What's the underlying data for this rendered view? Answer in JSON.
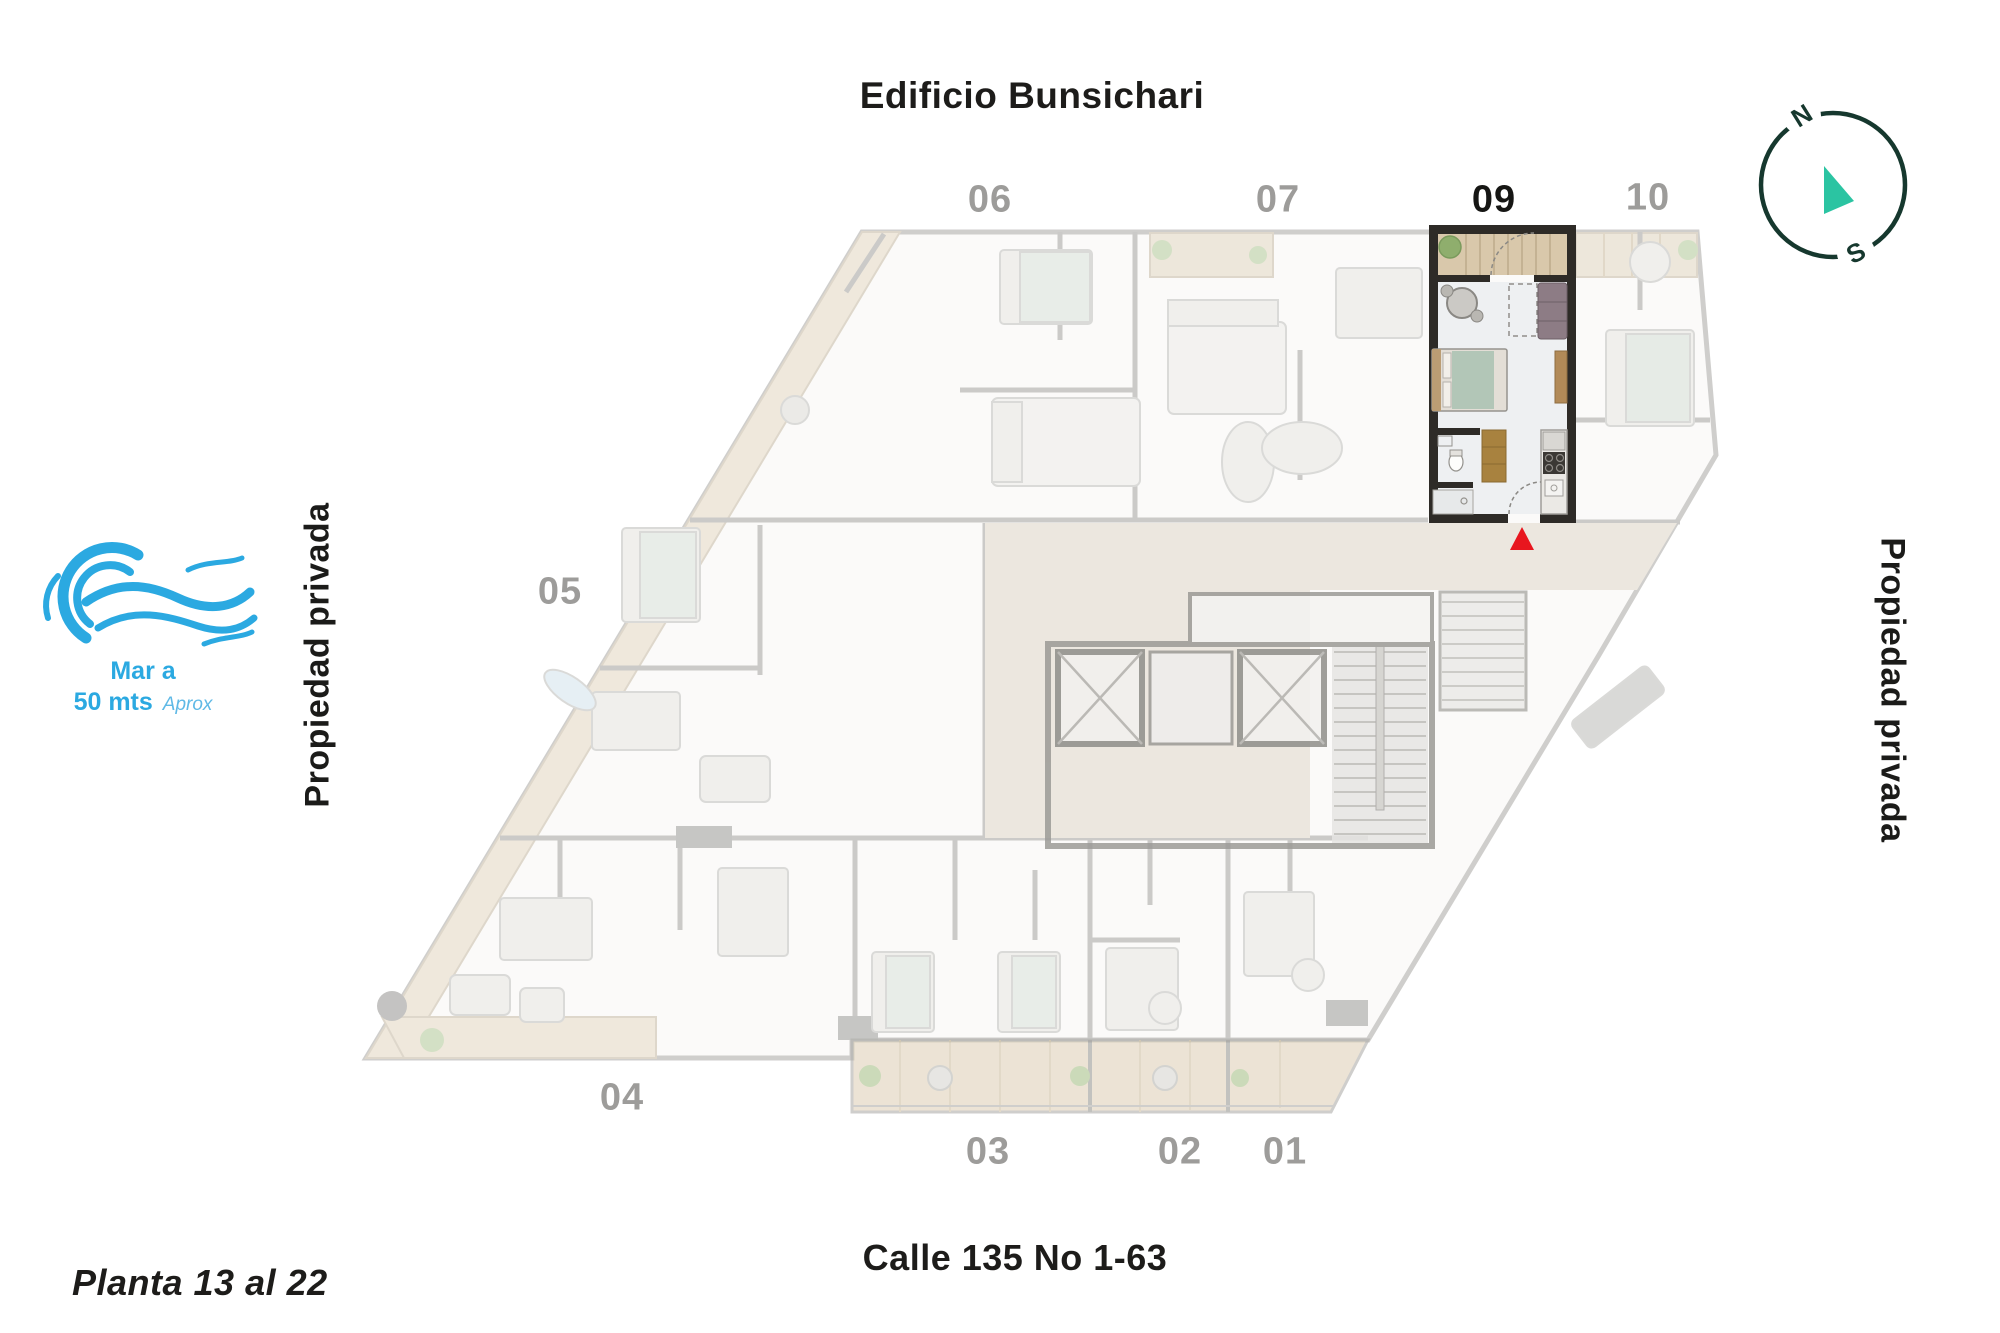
{
  "page": {
    "title": "Edificio Bunsichari",
    "street": "Calle 135 No 1-63",
    "floor_range": "Planta 13 al 22"
  },
  "property_labels": {
    "left": "Propiedad privada",
    "right": "Propiedad privada"
  },
  "sea": {
    "line1": "Mar a",
    "line2": "50 mts",
    "approx": "Aprox"
  },
  "compass": {
    "north": "N",
    "south": "S"
  },
  "units": {
    "highlighted_unit": "09",
    "top": [
      {
        "label": "06",
        "highlighted": false
      },
      {
        "label": "07",
        "highlighted": false
      },
      {
        "label": "09",
        "highlighted": true
      },
      {
        "label": "10",
        "highlighted": false
      }
    ],
    "left": [
      {
        "label": "05",
        "highlighted": false
      }
    ],
    "bottom": [
      {
        "label": "04",
        "highlighted": false
      },
      {
        "label": "03",
        "highlighted": false
      },
      {
        "label": "02",
        "highlighted": false
      },
      {
        "label": "01",
        "highlighted": false
      }
    ]
  },
  "colors": {
    "accent_red": "#e8161e",
    "compass_ring": "#16382e",
    "compass_pointer": "#2bc4a2",
    "sea_blue": "#2ba9e1",
    "corridor_beige": "#ece7df",
    "highlight_wall": "#2e2b27",
    "label_gray": "#9d9c9a",
    "text_black": "#1d1c1a",
    "wood": "#d9c8ab"
  }
}
